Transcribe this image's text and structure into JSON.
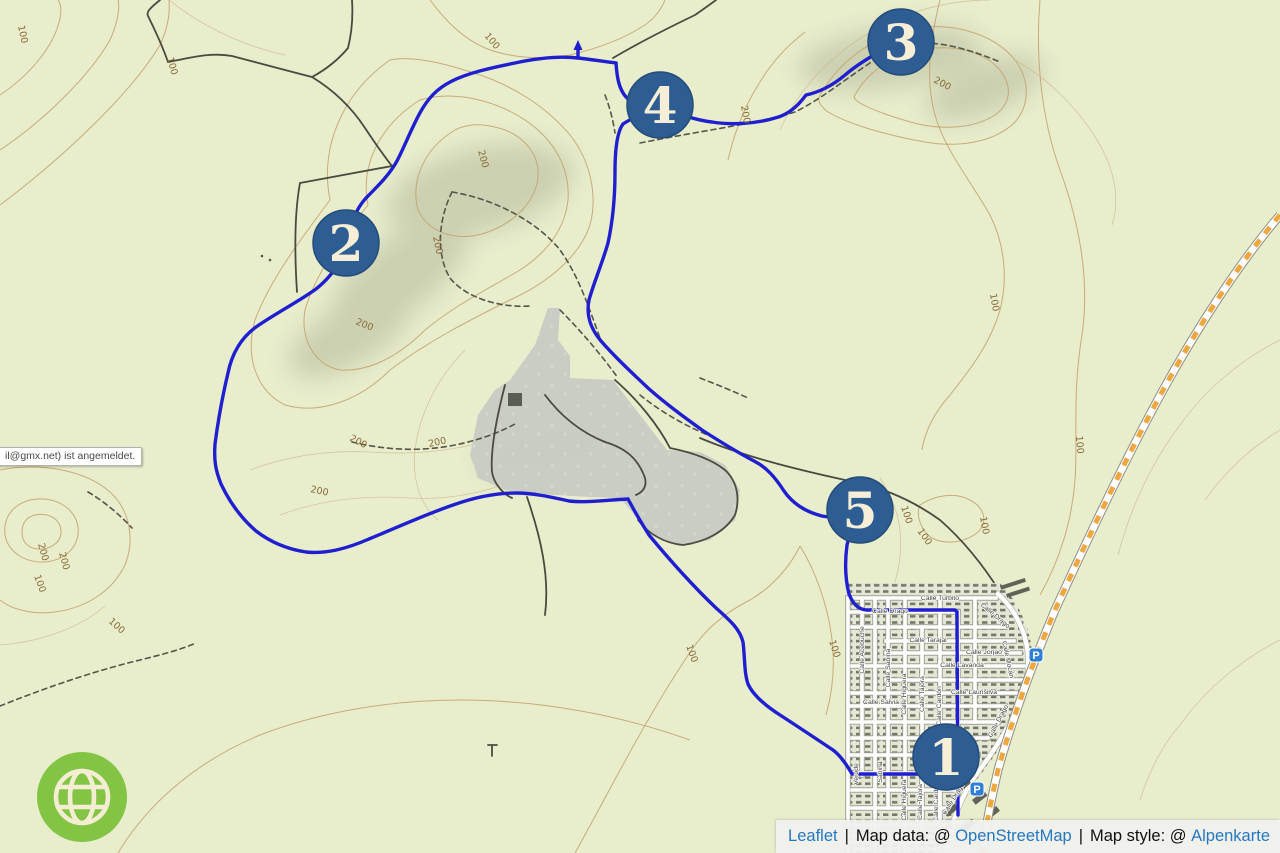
{
  "map": {
    "colors": {
      "background": "#e8edcc",
      "route": "#1f1fd0",
      "contour": "#c2a06b",
      "contour_label": "#8a6a38",
      "marker_fill": "#2d5d92",
      "marker_rim": "#244c7a",
      "marker_text": "#f6eed6",
      "parking_blue": "#2f7fd6",
      "construction_orange": "#efa73f",
      "logo_green": "#84c445",
      "logo_cream": "#f3eed2"
    },
    "markers": [
      {
        "label": "1",
        "x": 946,
        "y": 757
      },
      {
        "label": "2",
        "x": 346,
        "y": 243
      },
      {
        "label": "3",
        "x": 901,
        "y": 42
      },
      {
        "label": "4",
        "x": 660,
        "y": 105
      },
      {
        "label": "5",
        "x": 860,
        "y": 510
      }
    ],
    "contour_labels": [
      {
        "text": "100",
        "x": 18,
        "y": 26,
        "r": 78
      },
      {
        "text": "100",
        "x": 167,
        "y": 58,
        "r": 75
      },
      {
        "text": "100",
        "x": 484,
        "y": 36,
        "r": 50
      },
      {
        "text": "200",
        "x": 741,
        "y": 106,
        "r": 80
      },
      {
        "text": "200",
        "x": 933,
        "y": 82,
        "r": 28
      },
      {
        "text": "200",
        "x": 478,
        "y": 151,
        "r": 75
      },
      {
        "text": "200",
        "x": 433,
        "y": 237,
        "r": 78
      },
      {
        "text": "200",
        "x": 355,
        "y": 324,
        "r": 22
      },
      {
        "text": "200",
        "x": 349,
        "y": 440,
        "r": 28
      },
      {
        "text": "200",
        "x": 310,
        "y": 492,
        "r": 12
      },
      {
        "text": "200",
        "x": 429,
        "y": 447,
        "r": -12
      },
      {
        "text": "200",
        "x": 38,
        "y": 544,
        "r": 75
      },
      {
        "text": "200",
        "x": 59,
        "y": 553,
        "r": 75
      },
      {
        "text": "100",
        "x": 34,
        "y": 576,
        "r": 70
      },
      {
        "text": "100",
        "x": 108,
        "y": 622,
        "r": 42
      },
      {
        "text": "100",
        "x": 990,
        "y": 294,
        "r": 80
      },
      {
        "text": "100",
        "x": 1076,
        "y": 436,
        "r": 85
      },
      {
        "text": "100",
        "x": 901,
        "y": 507,
        "r": 72
      },
      {
        "text": "100",
        "x": 917,
        "y": 531,
        "r": 55
      },
      {
        "text": "100",
        "x": 980,
        "y": 517,
        "r": 80
      },
      {
        "text": "100",
        "x": 686,
        "y": 646,
        "r": 70
      },
      {
        "text": "100",
        "x": 829,
        "y": 641,
        "r": 72
      }
    ],
    "street_labels": [
      {
        "text": "Calle Turbito",
        "x": 940,
        "y": 600,
        "r": 0
      },
      {
        "text": "Calle Drago",
        "x": 890,
        "y": 613,
        "r": 0
      },
      {
        "text": "Calle Drago",
        "x": 994,
        "y": 617,
        "r": 40
      },
      {
        "text": "Calle Mocán",
        "x": 1006,
        "y": 660,
        "r": 78
      },
      {
        "text": "Calle Drago",
        "x": 1000,
        "y": 722,
        "r": -62
      },
      {
        "text": "Calle Drago",
        "x": 955,
        "y": 800,
        "r": -58
      },
      {
        "text": "Calle Acebuche",
        "x": 864,
        "y": 650,
        "r": -90
      },
      {
        "text": "Calle Sabina",
        "x": 890,
        "y": 668,
        "r": -90
      },
      {
        "text": "Calle Higuera",
        "x": 906,
        "y": 694,
        "r": -90
      },
      {
        "text": "Calle Tajora",
        "x": 924,
        "y": 694,
        "r": -90
      },
      {
        "text": "Calle Cardón",
        "x": 941,
        "y": 706,
        "r": -90
      },
      {
        "text": "Calle Tarajal",
        "x": 928,
        "y": 642,
        "r": 0
      },
      {
        "text": "Calle Jorjao",
        "x": 984,
        "y": 654,
        "r": 0
      },
      {
        "text": "Calle Lavanda",
        "x": 962,
        "y": 667,
        "r": 0
      },
      {
        "text": "Calle Laurisilva",
        "x": 974,
        "y": 694,
        "r": 0
      },
      {
        "text": "Calle Salvia",
        "x": 881,
        "y": 704,
        "r": 0
      },
      {
        "text": "Verode",
        "x": 858,
        "y": 774,
        "r": -90
      },
      {
        "text": "Sabina",
        "x": 882,
        "y": 772,
        "r": -90
      },
      {
        "text": "Calle Higuera",
        "x": 906,
        "y": 800,
        "r": -90
      },
      {
        "text": "Calle Tajora",
        "x": 922,
        "y": 802,
        "r": -90
      },
      {
        "text": "Calle Cardón",
        "x": 938,
        "y": 802,
        "r": -90
      }
    ],
    "parking_icons": [
      {
        "letter": "P",
        "x": 1036,
        "y": 655
      },
      {
        "letter": "P",
        "x": 977,
        "y": 789
      }
    ],
    "tooltip": {
      "text": "il@gmx.net) ist angemeldet."
    }
  },
  "attribution": {
    "leaflet_link": "Leaflet",
    "sep1": "|",
    "map_data_label": "Map data: @",
    "osm_link": "OpenStreetMap",
    "sep2": "|",
    "map_style_label": "Map style: @",
    "style_link": "Alpenkarte"
  }
}
